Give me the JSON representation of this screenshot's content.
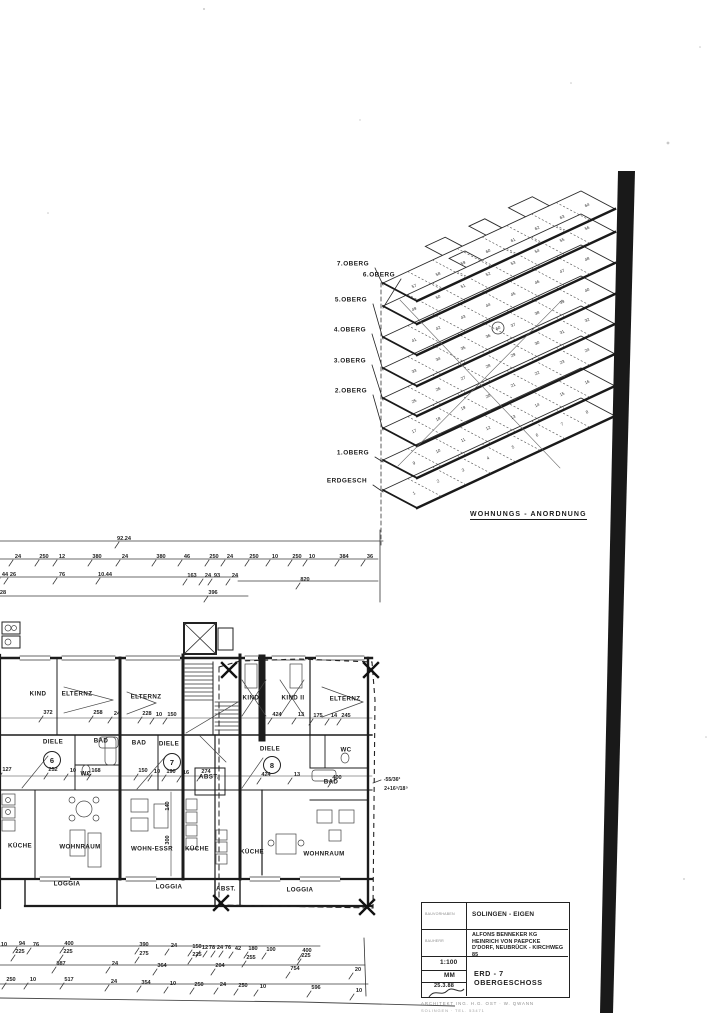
{
  "isometric": {
    "caption": "WOHNUNGS - ANORDNUNG",
    "floor_labels": [
      {
        "t": "7.OBERG",
        "x": 331,
        "y": 261,
        "f": 7
      },
      {
        "t": "6.OBERG",
        "x": 357,
        "y": 272,
        "f": 6
      },
      {
        "t": "5.OBERG",
        "x": 329,
        "y": 297,
        "f": 5
      },
      {
        "t": "4.OBERG",
        "x": 328,
        "y": 327,
        "f": 4
      },
      {
        "t": "3.OBERG",
        "x": 328,
        "y": 358,
        "f": 3
      },
      {
        "t": "2.OBERG",
        "x": 329,
        "y": 388,
        "f": 2
      },
      {
        "t": "1.OBERG",
        "x": 331,
        "y": 450,
        "f": 1
      },
      {
        "t": "ERDGESCH",
        "x": 325,
        "y": 478,
        "f": 0
      }
    ],
    "floors": [
      {
        "name": "ERDGESCH",
        "units": [
          1,
          2,
          3,
          4,
          5,
          6,
          7,
          8
        ]
      },
      {
        "name": "1.OBERG",
        "units": [
          9,
          10,
          11,
          12,
          13,
          14,
          15,
          16
        ]
      },
      {
        "name": "2.OBERG",
        "units": [
          17,
          18,
          19,
          20,
          21,
          22,
          23,
          24
        ]
      },
      {
        "name": "3.OBERG",
        "units": [
          25,
          26,
          27,
          28,
          29,
          30,
          31,
          32
        ]
      },
      {
        "name": "4.OBERG",
        "units": [
          33,
          34,
          35,
          36,
          37,
          38,
          39,
          40
        ]
      },
      {
        "name": "5.OBERG",
        "units": [
          41,
          42,
          43,
          44,
          45,
          46,
          47,
          48
        ]
      },
      {
        "name": "6.OBERG",
        "units": [
          49,
          50,
          51,
          52,
          53,
          54,
          55,
          56
        ]
      },
      {
        "name": "7.OBERG",
        "units": [
          57,
          58,
          59,
          60,
          61,
          62,
          63,
          64
        ]
      }
    ],
    "circled_unit": "60"
  },
  "plan": {
    "rooms": [
      [
        "KIND",
        38,
        694
      ],
      [
        "ELTERNZ",
        77,
        694
      ],
      [
        "ELTERNZ",
        146,
        697
      ],
      [
        "KIND I",
        253,
        698
      ],
      [
        "KIND II",
        293,
        698
      ],
      [
        "ELTERNZ",
        345,
        699
      ],
      [
        "DIELE",
        53,
        742
      ],
      [
        "BAD",
        101,
        741
      ],
      [
        "BAD",
        139,
        743
      ],
      [
        "DIELE",
        169,
        744
      ],
      [
        "DIELE",
        270,
        749
      ],
      [
        "WC",
        346,
        750
      ],
      [
        "WC",
        86,
        774
      ],
      [
        "ABST.",
        209,
        777
      ],
      [
        "BAD",
        331,
        782
      ],
      [
        "KÜCHE",
        20,
        846
      ],
      [
        "WOHNRAUM",
        80,
        847
      ],
      [
        "WOHN-ESSR",
        152,
        849
      ],
      [
        "KÜCHE",
        197,
        849
      ],
      [
        "KÜCHE",
        252,
        852
      ],
      [
        "WOHNRAUM",
        324,
        854
      ],
      [
        "LOGGIA",
        67,
        884
      ],
      [
        "LOGGIA",
        169,
        887
      ],
      [
        "ABST.",
        226,
        889
      ],
      [
        "LOGGIA",
        300,
        890
      ]
    ],
    "unit_circles": [
      {
        "n": "6",
        "x": 52,
        "y": 760
      },
      {
        "n": "7",
        "x": 172,
        "y": 762
      },
      {
        "n": "8",
        "x": 272,
        "y": 765
      }
    ],
    "dims_top": [
      [
        "92.24",
        124,
        536
      ],
      [
        "24",
        18,
        554
      ],
      [
        "250",
        44,
        554
      ],
      [
        "12",
        62,
        554
      ],
      [
        "380",
        97,
        554
      ],
      [
        "24",
        125,
        554
      ],
      [
        "380",
        161,
        554
      ],
      [
        "46",
        187,
        554
      ],
      [
        "250",
        214,
        554
      ],
      [
        "24",
        230,
        554
      ],
      [
        "250",
        254,
        554
      ],
      [
        "10",
        275,
        554
      ],
      [
        "250",
        297,
        554
      ],
      [
        "10",
        312,
        554
      ],
      [
        "384",
        344,
        554
      ],
      [
        "36",
        370,
        554
      ],
      [
        "44",
        5,
        572
      ],
      [
        "26",
        13,
        572
      ],
      [
        "76",
        62,
        572
      ],
      [
        "10.44",
        105,
        572
      ],
      [
        "163",
        192,
        573
      ],
      [
        "24",
        208,
        573
      ],
      [
        "93",
        217,
        573
      ],
      [
        "24",
        235,
        573
      ],
      [
        "820",
        305,
        577
      ],
      [
        "28",
        3,
        590
      ],
      [
        "396",
        213,
        590
      ]
    ],
    "dims_mid": [
      [
        "372",
        48,
        710
      ],
      [
        "258",
        98,
        710
      ],
      [
        "24",
        117,
        711
      ],
      [
        "228",
        147,
        711
      ],
      [
        "10",
        159,
        712
      ],
      [
        "150",
        172,
        712
      ],
      [
        "424",
        277,
        712
      ],
      [
        "13",
        301,
        712
      ],
      [
        "175",
        318,
        713
      ],
      [
        "14",
        334,
        713
      ],
      [
        "245",
        346,
        713
      ],
      [
        "127",
        7,
        767
      ],
      [
        "252",
        53,
        767
      ],
      [
        "10",
        73,
        768
      ],
      [
        "168",
        96,
        768
      ],
      [
        "150",
        143,
        768
      ],
      [
        "10",
        157,
        769
      ],
      [
        "190",
        171,
        769
      ],
      [
        "16",
        186,
        770
      ],
      [
        "274",
        206,
        769
      ],
      [
        "424",
        266,
        772
      ],
      [
        "13",
        297,
        772
      ],
      [
        "400",
        337,
        775
      ]
    ],
    "dims_bottom": [
      [
        "10",
        4,
        942
      ],
      [
        "94",
        22,
        941
      ],
      [
        "76",
        36,
        942
      ],
      [
        "400",
        69,
        941
      ],
      [
        "390",
        144,
        942
      ],
      [
        "24",
        174,
        943
      ],
      [
        "150",
        197,
        944
      ],
      [
        "12",
        205,
        945
      ],
      [
        "78",
        212,
        945
      ],
      [
        "24",
        220,
        945
      ],
      [
        "76",
        228,
        945
      ],
      [
        "42",
        238,
        946
      ],
      [
        "180",
        253,
        946
      ],
      [
        "100",
        271,
        947
      ],
      [
        "400",
        307,
        948
      ],
      [
        "225",
        20,
        949
      ],
      [
        "225",
        68,
        949
      ],
      [
        "275",
        144,
        951
      ],
      [
        "225",
        197,
        952
      ],
      [
        "255",
        251,
        955
      ],
      [
        "225",
        306,
        953
      ],
      [
        "887",
        61,
        961
      ],
      [
        "24",
        115,
        961
      ],
      [
        "364",
        162,
        963
      ],
      [
        "204",
        220,
        963
      ],
      [
        "754",
        295,
        966
      ],
      [
        "20",
        358,
        967
      ],
      [
        "250",
        11,
        977
      ],
      [
        "10",
        33,
        977
      ],
      [
        "517",
        69,
        977
      ],
      [
        "24",
        114,
        979
      ],
      [
        "354",
        146,
        980
      ],
      [
        "10",
        173,
        981
      ],
      [
        "250",
        199,
        982
      ],
      [
        "24",
        223,
        982
      ],
      [
        "250",
        243,
        983
      ],
      [
        "10",
        263,
        984
      ],
      [
        "596",
        316,
        985
      ],
      [
        "10",
        359,
        988
      ]
    ],
    "vdims": [
      [
        "140",
        168,
        806
      ],
      [
        "300",
        168,
        840
      ]
    ],
    "notes": [
      {
        "t": "-55/36²",
        "x": 392,
        "y": 780
      },
      {
        "t": "2+16⁵/18⁵",
        "x": 396,
        "y": 789
      }
    ]
  },
  "title_block": {
    "project_label": "BAUVORHABEN",
    "project": "SOLINGEN - EIGEN",
    "client_label": "BAUHERR",
    "client_lines": [
      "ALFONS BENNEKER KG",
      "HEINRICH VON PAEPCKE",
      "D'DORF, NEUBRÜCK - KIRCHWEG 85"
    ],
    "scale": "1:100",
    "drawn_by": "MM",
    "date": "25.3.88",
    "drawing_title": "ERD - 7 OBERGESCHOSS",
    "footer_line1": "ARCHITEKT  ING. H.G. OST · W. QWANN",
    "footer_line2": "SOLINGEN · TEL. 53471"
  }
}
